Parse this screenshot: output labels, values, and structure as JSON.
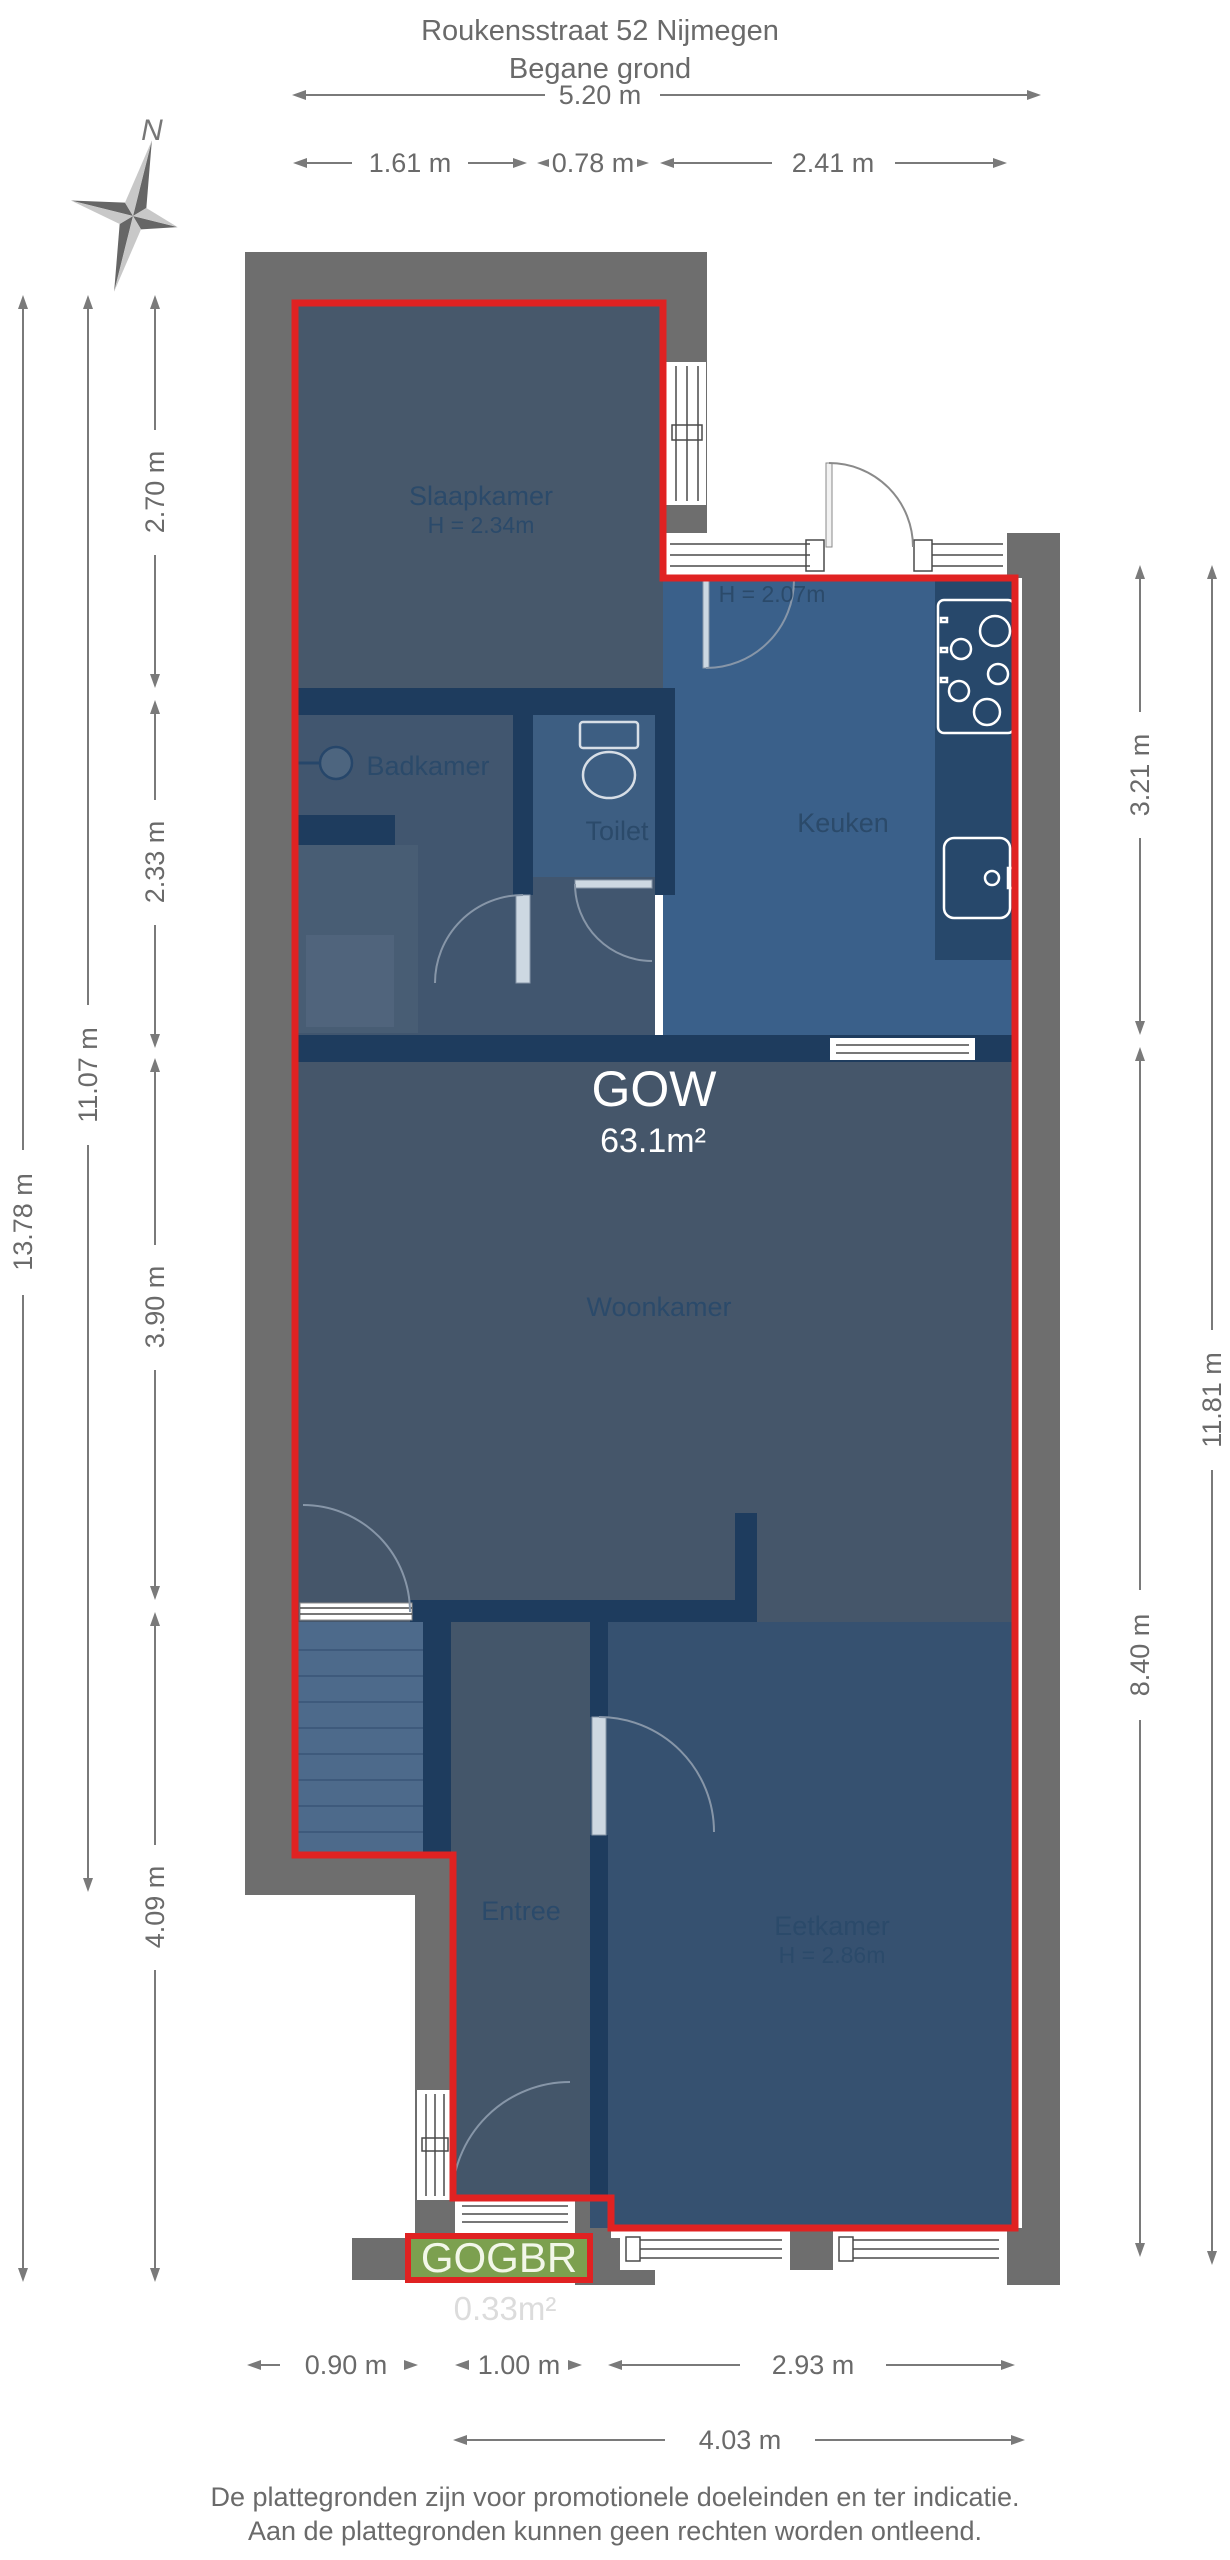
{
  "title": {
    "line1": "Roukensstraat 52 Nijmegen",
    "line2": "Begane grond"
  },
  "compass": {
    "north_label": "N"
  },
  "dimensions": {
    "top_total": "5.20 m",
    "top_segments": [
      "1.61 m",
      "0.78 m",
      "2.41 m"
    ],
    "left_inner": [
      "2.70 m",
      "2.33 m",
      "3.90 m",
      "4.09 m"
    ],
    "left_middle": "11.07 m",
    "left_outer": "13.78 m",
    "right_inner": [
      "3.21 m",
      "8.40 m"
    ],
    "right_outer": "11.81 m",
    "bottom_segments": [
      "0.90 m",
      "1.00 m",
      "2.93 m"
    ],
    "bottom_total": "4.03 m"
  },
  "rooms": {
    "slaapkamer": {
      "name": "Slaapkamer",
      "height": "H = 2.34m"
    },
    "badkamer": {
      "name": "Badkamer"
    },
    "toilet": {
      "name": "Toilet"
    },
    "keuken": {
      "name": "Keuken",
      "height": "H = 2.07m"
    },
    "woonkamer": {
      "name": "Woonkamer"
    },
    "entree": {
      "name": "Entree"
    },
    "eetkamer": {
      "name": "Eetkamer",
      "height": "H = 2.86m"
    }
  },
  "areas": {
    "gow": {
      "label": "GOW",
      "area": "63.1m²"
    },
    "gogbr": {
      "label": "GOGBR",
      "area": "0.33m²"
    }
  },
  "footer": {
    "line1": "De plattegronden zijn voor promotionele doeleinden en ter indicatie.",
    "line2": "Aan de plattegronden kunnen geen rechten worden ontleend."
  },
  "colors": {
    "red_outline": "#e02222",
    "wall_gray": "#6e6e6e",
    "interior_wall_navy": "#1e3c5e",
    "room_slate": "#45566a",
    "kitchen_blue": "#3a608a",
    "eetkamer_blue": "#365170",
    "stairs_blue": "#4d6a8b",
    "gogbr_green": "#7ca04f",
    "dim_text_gray": "#6a6a6a"
  }
}
